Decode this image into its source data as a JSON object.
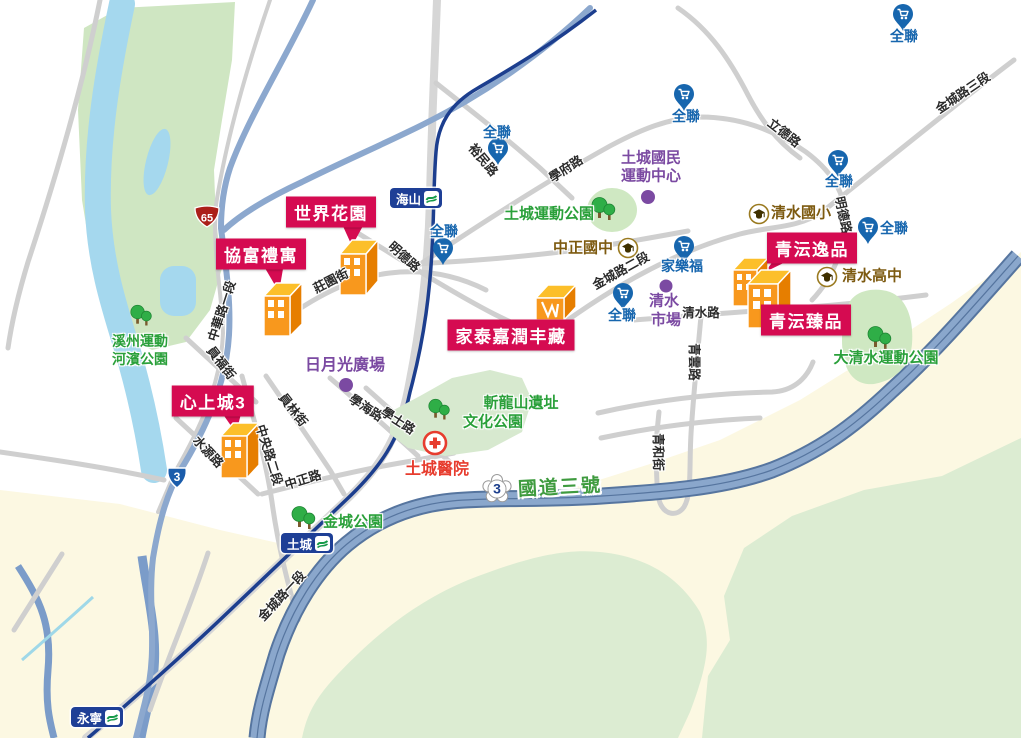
{
  "properties": {
    "shijiehuayuan": "世界花園",
    "xiefuliyu": "協富禮寓",
    "xinshangcheng3": "心上城3",
    "jiatai": "家泰嘉潤丰藏",
    "qingyun_yipin": "青沄逸品",
    "qingyun_zhenpin": "青沄臻品"
  },
  "stations": {
    "haishan": "海山",
    "tucheng": "土城",
    "yongning": "永寧"
  },
  "stores": {
    "pxmart": "全聯",
    "carrefour": "家樂福"
  },
  "schools": {
    "zhongzheng_junior_high": "中正國中",
    "qingshui_elementary": "清水國小",
    "qingshui_senior_high": "清水高中"
  },
  "parks": {
    "xizhou_line1": "溪州運動",
    "xizhou_line2": "河濱公園",
    "tucheng_sport": "土城運動公園",
    "zhanlongshan_line1": "斬龍山遺址",
    "zhanlongshan_line2": "文化公園",
    "jincheng": "金城公園",
    "daqingshui": "大清水運動公園"
  },
  "places": {
    "sports_center_line1": "土城國民",
    "sports_center_line2": "運動中心",
    "riyueguang_plaza": "日月光廣場",
    "market_line1": "清水",
    "market_line2": "市場"
  },
  "hospital": {
    "name": "土城醫院"
  },
  "roads": [
    "裕民路",
    "學府路",
    "立德路",
    "金城路三段",
    "明德路",
    "明德路",
    "莊園街",
    "中華路一段",
    "員福街",
    "員林街",
    "學海路",
    "學士路",
    "水源路",
    "中央路二段",
    "中正路",
    "金城路一段",
    "金城路二段",
    "清水路",
    "青雲路",
    "青和街"
  ],
  "highways": {
    "national3_shield": "3",
    "national3_label": "國道三號",
    "expressway65_shield": "65",
    "provincial3_shield": "3"
  },
  "colors": {
    "callout_bg": "#d50b51",
    "pxmart_blue": "#1766ae",
    "park_green": "#2aa03a",
    "poi_purple": "#7b4aa2",
    "school_brown": "#7d5a10",
    "hospital_red": "#e73c2e",
    "mrt_navy": "#1c3e8e",
    "highway_fill": "#8aa7cc",
    "building_orange": "#f8981d",
    "lowland_cream": "#fcf8e2",
    "wilderness_green": "#dcecd2",
    "river_blue": "#a5d8ee"
  }
}
